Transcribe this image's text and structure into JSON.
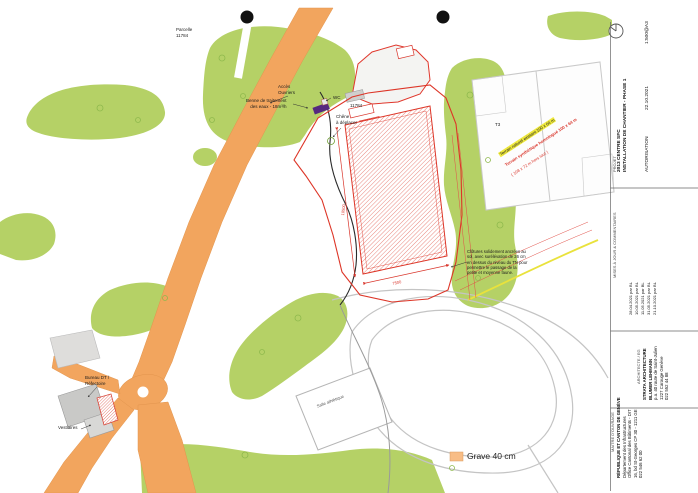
{
  "map": {
    "labels": {
      "parcelle": "Parcelle\n11784",
      "acces": "Accès\nOuvriers",
      "benne": "Benne de traitement\ndes eaux - 18m³/h",
      "wc": "WC",
      "parcel_num": "11784",
      "chene": "Chêne\nà déplacer",
      "t3": "T3",
      "terrain_jaune": "Terrain naturel existant 100 x 64 m",
      "terrain_rouge_1": "Terrain synthétique homologué 100 x 64 m",
      "terrain_rouge_2": "( 108 x 72 m hors tout )",
      "note_clotures": "Clôtures solidement ancrées au\nsol, avec surélévation de 26 cm\nen dessus du niveau du TN pour\npermettre le passage de la\npetite et moyenne faune.",
      "bureau": "Bureau DT /\nRéfectoire",
      "vestiaires": "Vestiaires",
      "salle": "Salle athlétique",
      "dim_long": "10500",
      "dim_court": "7500"
    },
    "legend": {
      "label": "Grave 40 cm"
    }
  },
  "titleblock": {
    "projet": {
      "label": "PROJET",
      "name": "2013 CENTRE SFC",
      "subtitle": "INSTALLATION DE CHANTIER - PHASE 1",
      "status": "AUTORISATION",
      "date": "22.10.2021",
      "scale": "1:500@A3"
    },
    "mises": {
      "label": "MISES À JOUR & COMMENTAIRES",
      "entries": [
        "28.04.2021  par BL",
        "10.05.2021  par BL",
        "11.05.2021  par BL",
        "31.05.2021  par BL",
        "21.10.2021  par BL"
      ]
    },
    "architecte": {
      "label": "ARCHITECTE / EG",
      "lines": [
        "STRATA ARCHITECTURE",
        "BLUMER LEHMANN",
        "p.a. 40 route de Saint-Julien",
        "1227 Carouge Genève",
        "022 552 44 88"
      ]
    },
    "maitre": {
      "label": "MAITRE D'OUVRAGE",
      "lines": [
        "RÉPUBLIQUE ET CANTON DE GENÈVE",
        "Département des Infrastructures",
        "Office Cantonal des Bâtiments - DIT",
        "16, bd St-Georges CP 30 - 1211 GE",
        "022 546 62 00"
      ]
    }
  },
  "colors": {
    "green": "#b5d166",
    "road_orange": "#f2a55e",
    "construction_red": "#dd3527",
    "benne_purple": "#55297f",
    "utility_yellow": "#e9e23c",
    "legend_orange": "#f8bd86"
  }
}
